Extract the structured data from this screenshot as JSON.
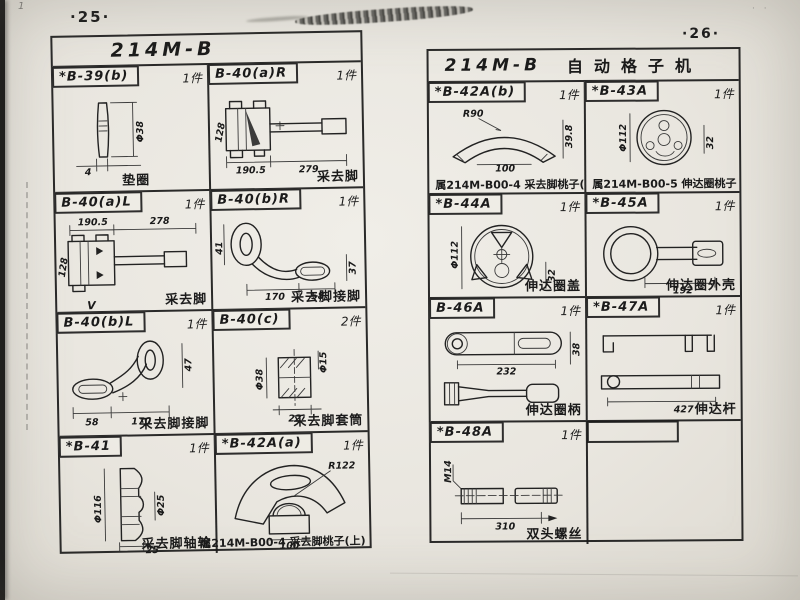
{
  "meta": {
    "left_page_number": "·25·",
    "right_page_number": "·26·",
    "corner_mark": "1"
  },
  "left_table": {
    "title": "214M-B",
    "cells": {
      "b39b": {
        "part_no": "*B-39(b)",
        "qty": "1件",
        "caption": "垫圈",
        "dims": {
          "dia": "Φ38",
          "w": "4"
        }
      },
      "b40aR": {
        "part_no": "B-40(a)R",
        "qty": "1件",
        "caption": "采去脚",
        "dims": {
          "h": "128",
          "l1": "190.5",
          "l2": "279"
        }
      },
      "b40aL": {
        "part_no": "B-40(a)L",
        "qty": "1件",
        "caption": "采去脚",
        "extra": "V",
        "dims": {
          "l1": "190.5",
          "l2": "278",
          "h": "128"
        }
      },
      "b40bR": {
        "part_no": "B-40(b)R",
        "qty": "1件",
        "caption": "采去脚接脚",
        "dims": {
          "h": "41",
          "l1": "170",
          "l2": "58",
          "r": "37"
        }
      },
      "b40bL": {
        "part_no": "B-40(b)L",
        "qty": "1件",
        "caption": "采去脚接脚",
        "dims": {
          "l0": "58",
          "l1": "170",
          "r": "47"
        }
      },
      "b40c": {
        "part_no": "B-40(c)",
        "qty": "2件",
        "caption": "采去脚套筒",
        "dims": {
          "dia1": "Φ38",
          "dia2": "Φ15",
          "w": "22"
        }
      },
      "b41": {
        "part_no": "*B-41",
        "qty": "1件",
        "caption": "采去脚轴轮",
        "dims": {
          "dia1": "Φ116",
          "dia2": "Φ25",
          "w": "25"
        }
      },
      "b42aa": {
        "part_no": "*B-42A(a)",
        "qty": "1件",
        "caption": "属214M-B00-4 采去脚桃子(上)",
        "dims": {
          "r": "R122",
          "w": "100"
        }
      }
    }
  },
  "right_table": {
    "title": "214M-B",
    "subtitle": "自动格子机",
    "cells": {
      "b42ab": {
        "part_no": "*B-42A(b)",
        "qty": "1件",
        "caption": "属214M-B00-4 采去脚桃子(下)",
        "dims": {
          "r": "R90",
          "h": "39.8",
          "w": "100"
        }
      },
      "b43a": {
        "part_no": "*B-43A",
        "qty": "1件",
        "caption": "属214M-B00-5 伸达圈桃子",
        "dims": {
          "dia": "Φ112",
          "h": "32"
        }
      },
      "b44a": {
        "part_no": "*B-44A",
        "qty": "1件",
        "caption": "伸达圈盖",
        "dims": {
          "dia": "Φ112",
          "h": "32"
        }
      },
      "b45a": {
        "part_no": "*B-45A",
        "qty": "1件",
        "caption": "伸达圈外壳",
        "dims": {
          "l": "192"
        }
      },
      "b46a": {
        "part_no": "B-46A",
        "qty": "1件",
        "caption": "伸达圈柄",
        "dims": {
          "l": "232",
          "h": "38"
        }
      },
      "b47a": {
        "part_no": "*B-47A",
        "qty": "1件",
        "caption": "伸达杆",
        "dims": {
          "l": "427"
        }
      },
      "b48a": {
        "part_no": "*B-48A",
        "qty": "1件",
        "caption": "双头螺丝",
        "dims": {
          "thread": "M14",
          "l": "310"
        }
      }
    }
  }
}
